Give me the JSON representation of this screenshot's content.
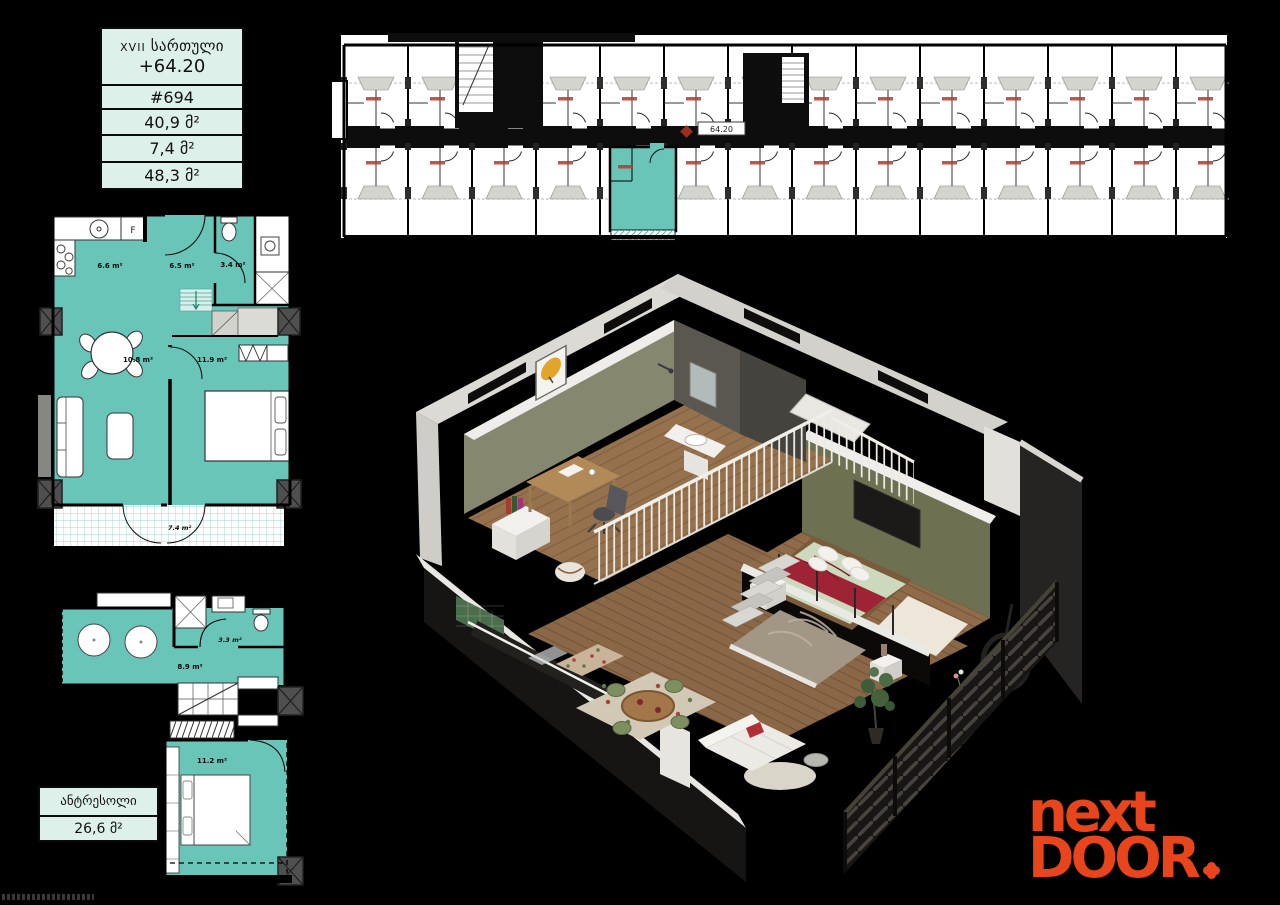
{
  "colors": {
    "teal": "#6ac5b9",
    "card_bg": "#def0ea",
    "logo_orange": "#e8451c",
    "background": "#000000"
  },
  "unit_card": {
    "floor_roman": "XVII",
    "floor_word": "სართული",
    "elevation": "+64.20",
    "unit_number": "#694",
    "area_main": "40,9 მ²",
    "area_balcony": "7,4 მ²",
    "area_total": "48,3 მ²"
  },
  "mezzanine_card": {
    "title": "ანტრესოლი",
    "area": "26,6 მ²"
  },
  "site_plan": {
    "unit_marker": "64.20"
  },
  "main_plan": {
    "kitchen_area": "6.6 m²",
    "hall_area": "6.5 m²",
    "bathroom_area": "3.4 m²",
    "living_area": "10.8 m²",
    "bedroom_area": "11.9 m²",
    "balcony_area": "7.4 m²",
    "fridge_label": "F"
  },
  "mezz_plan": {
    "bathroom_area": "3.3 m²",
    "hall_area": "8.9 m²",
    "bedroom_area": "11.2 m²"
  },
  "logo": {
    "word1": "next",
    "word2": "DOOR",
    "dot_icon": "flower-dot"
  }
}
